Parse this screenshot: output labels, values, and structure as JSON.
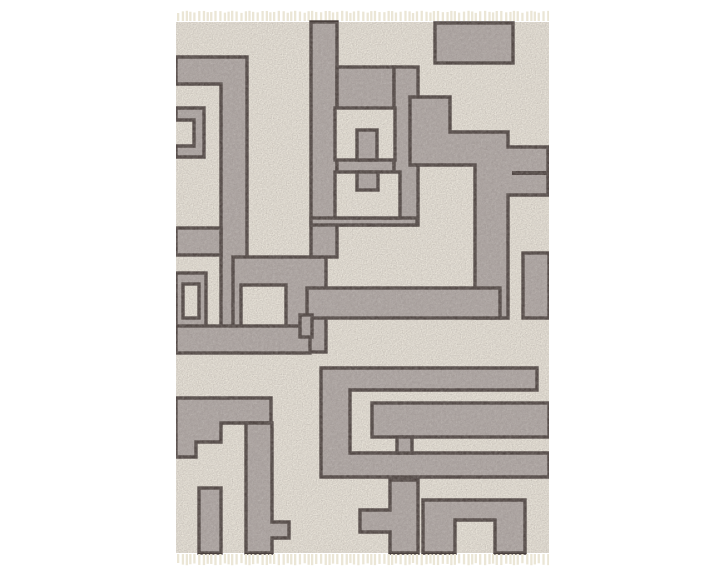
{
  "product_photo": {
    "alt": "Gray and ivory area rug with geometric maze pattern and fringe tassels",
    "colors": {
      "background": "#ffffff",
      "field": "#ece7dc",
      "band": "#b0a8a5",
      "outline": "#493f3c",
      "fringe": "#ebe6d6"
    },
    "rug": {
      "left": 176,
      "top": 22,
      "width": 373,
      "height": 531
    },
    "fringe": {
      "tassel_color": "#ebe6d6",
      "tassel_width": 2.3,
      "spacing": 4.2,
      "top_height": 8,
      "bottom_height": 9
    },
    "outline_width": 3.4,
    "pattern_shapes": [
      {
        "name": "spiral-arm",
        "t": "poly",
        "pts": [
          [
            0,
            35
          ],
          [
            71,
            35
          ],
          [
            71,
            330
          ],
          [
            45,
            330
          ],
          [
            45,
            62
          ],
          [
            0,
            62
          ]
        ],
        "f": "band"
      },
      {
        "name": "spiral-left-arm",
        "t": "rect",
        "x": 0,
        "y": 206,
        "w": 45,
        "h": 27,
        "f": "band"
      },
      {
        "name": "left-edge-block",
        "t": "path",
        "d": "M0,86 H28 V135 H0 V124 H18 V98 H0 Z",
        "f": "band"
      },
      {
        "name": "left-edge-ring-outer",
        "t": "rect",
        "x": 0,
        "y": 251,
        "w": 30,
        "h": 57,
        "f": "band"
      },
      {
        "name": "left-edge-ring-inner",
        "t": "rect",
        "x": 7,
        "y": 262,
        "w": 16,
        "h": 34,
        "f": "field"
      },
      {
        "name": "mid-left-slab",
        "t": "rect",
        "x": 57,
        "y": 235,
        "w": 93,
        "h": 95,
        "f": "band"
      },
      {
        "name": "mid-left-window",
        "t": "rect",
        "x": 65,
        "y": 263,
        "w": 45,
        "h": 45,
        "f": "field"
      },
      {
        "name": "left-band",
        "t": "rect",
        "x": 0,
        "y": 304,
        "w": 134,
        "h": 27,
        "f": "band"
      },
      {
        "name": "top-rail",
        "t": "rect",
        "x": 135,
        "y": 0,
        "w": 26,
        "h": 235,
        "f": "band"
      },
      {
        "name": "center-fill",
        "t": "rect",
        "x": 161,
        "y": 45,
        "w": 57,
        "h": 158,
        "f": "band"
      },
      {
        "name": "key-rail",
        "t": "rect",
        "x": 218,
        "y": 45,
        "w": 24,
        "h": 158,
        "f": "band"
      },
      {
        "name": "right-mass",
        "t": "poly",
        "pts": [
          [
            234,
            75
          ],
          [
            274,
            75
          ],
          [
            274,
            110
          ],
          [
            332,
            110
          ],
          [
            332,
            125
          ],
          [
            372,
            125
          ],
          [
            372,
            173
          ],
          [
            332,
            173
          ],
          [
            332,
            296
          ],
          [
            299,
            296
          ],
          [
            299,
            143
          ],
          [
            234,
            143
          ]
        ],
        "f": "band"
      },
      {
        "name": "blob-bottom-strip",
        "t": "rect",
        "x": 135,
        "y": 196,
        "w": 106,
        "h": 7,
        "f": "band"
      },
      {
        "name": "top-rect",
        "t": "rect",
        "x": 259,
        "y": 1,
        "w": 78,
        "h": 40,
        "f": "band"
      },
      {
        "name": "upper-window",
        "t": "rect",
        "x": 159,
        "y": 86,
        "w": 60,
        "h": 52,
        "f": "field"
      },
      {
        "name": "upper-tab",
        "t": "rect",
        "x": 181,
        "y": 108,
        "w": 20,
        "h": 30,
        "f": "band"
      },
      {
        "name": "lower-window",
        "t": "rect",
        "x": 159,
        "y": 150,
        "w": 65,
        "h": 46,
        "f": "field"
      },
      {
        "name": "lower-tab",
        "t": "rect",
        "x": 181,
        "y": 150,
        "w": 21,
        "h": 18,
        "f": "band"
      },
      {
        "name": "central-band",
        "t": "rect",
        "x": 131,
        "y": 266,
        "w": 193,
        "h": 30,
        "f": "band"
      },
      {
        "name": "central-band-foot",
        "t": "rect",
        "x": 124,
        "y": 293,
        "w": 12,
        "h": 22,
        "f": "band"
      },
      {
        "name": "right-edge-block",
        "t": "rect",
        "x": 347,
        "y": 231,
        "w": 26,
        "h": 65,
        "f": "band"
      },
      {
        "name": "edge-strip-line",
        "t": "rect",
        "x": 336,
        "y": 149,
        "w": 37,
        "h": 4,
        "f": "outline",
        "s": false
      },
      {
        "name": "c-spiral",
        "t": "poly",
        "pts": [
          [
            145,
            346
          ],
          [
            361,
            346
          ],
          [
            361,
            368
          ],
          [
            174,
            368
          ],
          [
            174,
            431
          ],
          [
            373,
            431
          ],
          [
            373,
            455
          ],
          [
            145,
            455
          ]
        ],
        "f": "band"
      },
      {
        "name": "thick-band",
        "t": "rect",
        "x": 196,
        "y": 381,
        "w": 177,
        "h": 34,
        "f": "band"
      },
      {
        "name": "thick-band-link",
        "t": "rect",
        "x": 221,
        "y": 415,
        "w": 15,
        "h": 16,
        "f": "band"
      },
      {
        "name": "bottom-left-edge-block",
        "t": "poly",
        "pts": [
          [
            0,
            376
          ],
          [
            95,
            376
          ],
          [
            95,
            401
          ],
          [
            45,
            401
          ],
          [
            45,
            420
          ],
          [
            20,
            420
          ],
          [
            20,
            435
          ],
          [
            0,
            435
          ]
        ],
        "f": "band"
      },
      {
        "name": "bottom-left-vband",
        "t": "poly",
        "pts": [
          [
            70,
            401
          ],
          [
            96,
            401
          ],
          [
            96,
            500
          ],
          [
            113,
            500
          ],
          [
            113,
            516
          ],
          [
            96,
            516
          ],
          [
            96,
            531
          ],
          [
            70,
            531
          ]
        ],
        "f": "band"
      },
      {
        "name": "bottom-left-small-band",
        "t": "rect",
        "x": 23,
        "y": 466,
        "w": 22,
        "h": 65,
        "f": "band"
      },
      {
        "name": "bottom-center-staircase",
        "t": "poly",
        "pts": [
          [
            214,
            458
          ],
          [
            242,
            458
          ],
          [
            242,
            531
          ],
          [
            214,
            531
          ],
          [
            214,
            510
          ],
          [
            184,
            510
          ],
          [
            184,
            488
          ],
          [
            214,
            488
          ]
        ],
        "f": "band"
      },
      {
        "name": "bottom-right-nested-u",
        "t": "path",
        "d": "M247,478 H349 V531 H319 V498 H279 V531 H247 Z",
        "f": "band"
      }
    ]
  }
}
